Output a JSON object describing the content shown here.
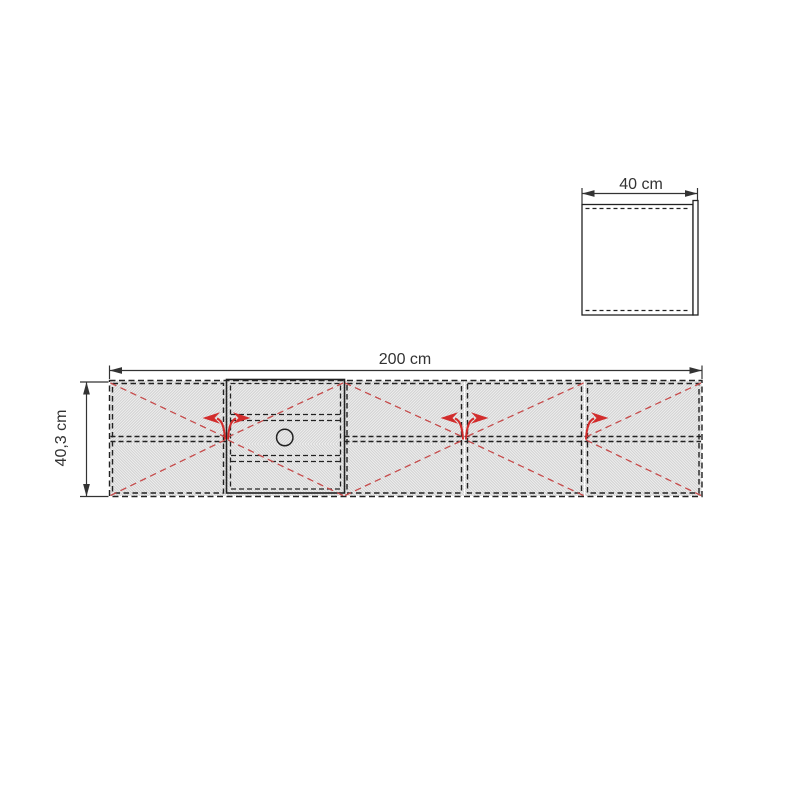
{
  "page": {
    "background": "#ffffff"
  },
  "dimensions": {
    "width": {
      "label": "200 cm"
    },
    "height": {
      "label": "40,3 cm"
    },
    "depth": {
      "label": "40 cm"
    }
  },
  "front_view": {
    "sections": [
      {
        "id": "door-1",
        "type": "door",
        "swing_apex": "right"
      },
      {
        "id": "drawer-unit",
        "type": "drawer-compartment",
        "swing_apex": "left",
        "cable_hole": true,
        "drawer_lines": 2
      },
      {
        "id": "door-2",
        "type": "door",
        "swing_apex": "right"
      },
      {
        "id": "door-3",
        "type": "door",
        "swing_apex": "left"
      },
      {
        "id": "door-4",
        "type": "door",
        "swing_apex": "left"
      }
    ],
    "shelf_line": true
  },
  "side_view": {
    "front_panel": true,
    "hidden_edges": 2
  },
  "colors": {
    "outline": "#222222",
    "dimension": "#333333",
    "swing_guide": "#c64a4a",
    "arrow": "#d22c2c",
    "texture_line": "#d2d2d2",
    "panel_fill": "#f1f1f1",
    "side_fill": "#ffffff"
  }
}
